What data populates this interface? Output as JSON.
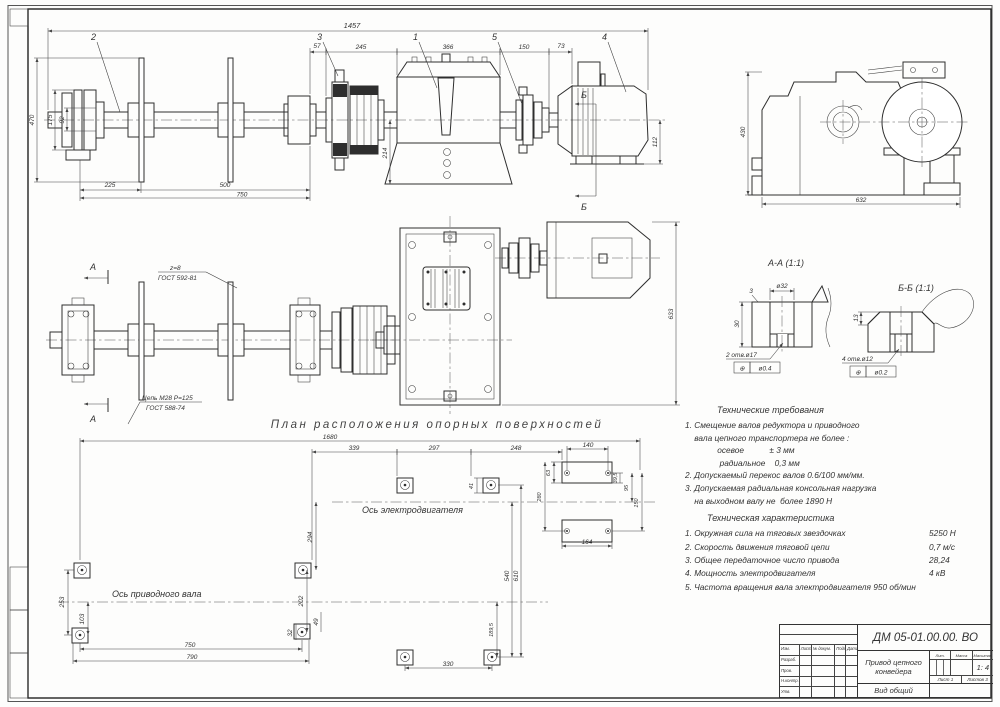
{
  "caption": "План расположения опорных поверхностей",
  "front": {
    "callout_1": "1",
    "callout_2": "2",
    "callout_3": "3",
    "callout_4": "4",
    "callout_5": "5",
    "dim_overall": "1457",
    "dim_seg_57": "57",
    "dim_seg_245": "245",
    "dim_seg_366": "366",
    "dim_seg_150": "150",
    "dim_seg_73": "73",
    "dim_470": "470",
    "dim_175": "175",
    "dim_92": "92",
    "dim_225": "225",
    "dim_500": "500",
    "dim_750": "750",
    "dim_214": "214",
    "dim_112": "112",
    "section_label_b": "Б"
  },
  "end_view": {
    "dim_430": "430",
    "dim_632": "632"
  },
  "plan_shaft": {
    "section_label_a": "А",
    "note_z": "z=8",
    "note_z_gost": "ГОСТ 592-81",
    "note_chain": "Цепь М28 P=125",
    "note_chain_gost": "ГОСТ 588-74"
  },
  "plan_drive": {
    "dim_633": "633"
  },
  "section_aa": {
    "title": "А-А (1:1)",
    "dim_dia": "ø32",
    "dim_30": "30",
    "dim_3": "3",
    "holes": "2 отв.ø17",
    "tol_sym": "⊕",
    "tol_val": "ø0.4"
  },
  "section_bb": {
    "title": "Б-Б (1:1)",
    "dim_13": "13",
    "holes": "4 отв.ø12",
    "tol_sym": "⊕",
    "tol_val": "ø0.2"
  },
  "layout": {
    "axis_motor": "Ось электродвигателя",
    "axis_shaft": "Ось приводного вала",
    "dim_1680": "1680",
    "dim_339": "339",
    "dim_297": "297",
    "dim_248": "248",
    "dim_140": "140",
    "dim_253": "253",
    "dim_103": "103",
    "dim_294": "294",
    "dim_202": "202",
    "dim_49": "49",
    "dim_32": "32",
    "dim_41": "41",
    "dim_540": "540",
    "dim_610": "610",
    "dim_189": "189,5",
    "dim_330": "330",
    "dim_750": "750",
    "dim_790": "790",
    "dim_63": "63",
    "dim_39": "39,5",
    "dim_95": "95",
    "dim_150": "150",
    "dim_280": "280",
    "dim_164": "164"
  },
  "tech": {
    "req_title": "Технические требования",
    "req_lines": [
      "1. Смещение валов редуктора и приводного",
      "    вала цепного транспортера не более :",
      "              осевое           ± 3 мм",
      "               радиальное    0,3 мм",
      "2. Допускаемый перекос валов 0.6/100 мм/мм.",
      "3. Допускаемая радиальная консольная нагрузка",
      "    на выходном валу не  более 1890 Н"
    ],
    "char_title": "Техническая характеристика",
    "char_rows": [
      {
        "text": "1. Окружная сила на тяговых звездочках",
        "value": "5250 Н"
      },
      {
        "text": "2. Скорость движения тяговой цепи",
        "value": "0,7 м/с"
      },
      {
        "text": "3. Общее передаточное число привода",
        "value": "28,24"
      },
      {
        "text": "4. Мощность электродвигателя",
        "value": "4 кВ"
      },
      {
        "text": "5. Частота вращения вала электродвигателя 950 об/мин",
        "value": ""
      }
    ]
  },
  "title_block": {
    "doc_number": "ДМ 05-01.00.00. ВО",
    "name": "Привод цепного конвейера",
    "view_label": "Вид общий",
    "lit": "Лит.",
    "mass": "Масса",
    "scale_h": "Масштаб",
    "scale": "1: 4",
    "sheet": "Лист 1",
    "sheets": "Листов 3",
    "h_izm": "Изм.",
    "h_list": "Лист",
    "h_doc": "№ докум.",
    "h_sign": "Подп.",
    "h_date": "Дата",
    "r_razrab": "Разраб.",
    "r_prov": "Пров.",
    "r_nkontr": "Н.контр.",
    "r_utv": "Утв."
  }
}
